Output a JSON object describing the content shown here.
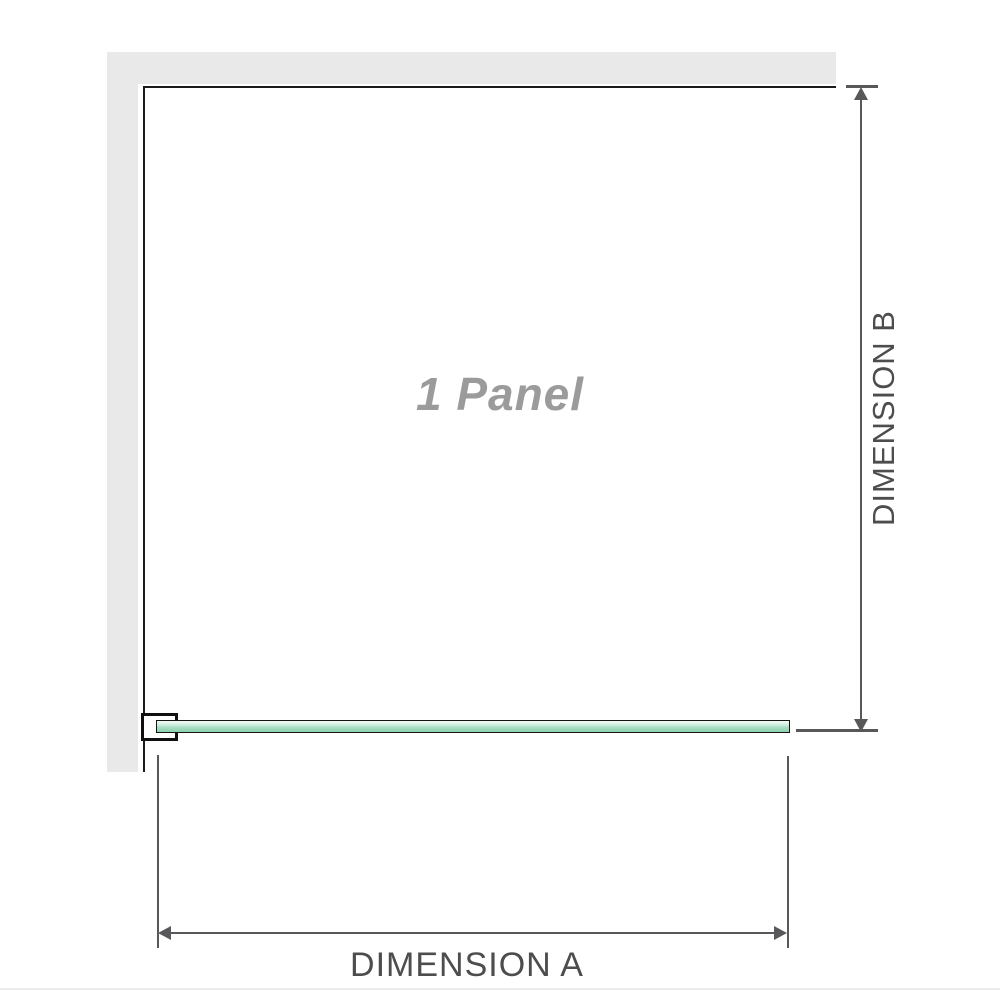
{
  "diagram": {
    "panel_label": "1 Panel",
    "dimension_a_label": "DIMENSION A",
    "dimension_b_label": "DIMENSION B",
    "colors": {
      "wall_gray": "#e9e9e9",
      "panel_outline": "#1b1b1b",
      "dimension_gray": "#58585a",
      "panel_label_gray": "#9b9b9b",
      "glass_green_light": "#f2fbf6",
      "glass_green_dark": "#8bd0ae"
    }
  }
}
